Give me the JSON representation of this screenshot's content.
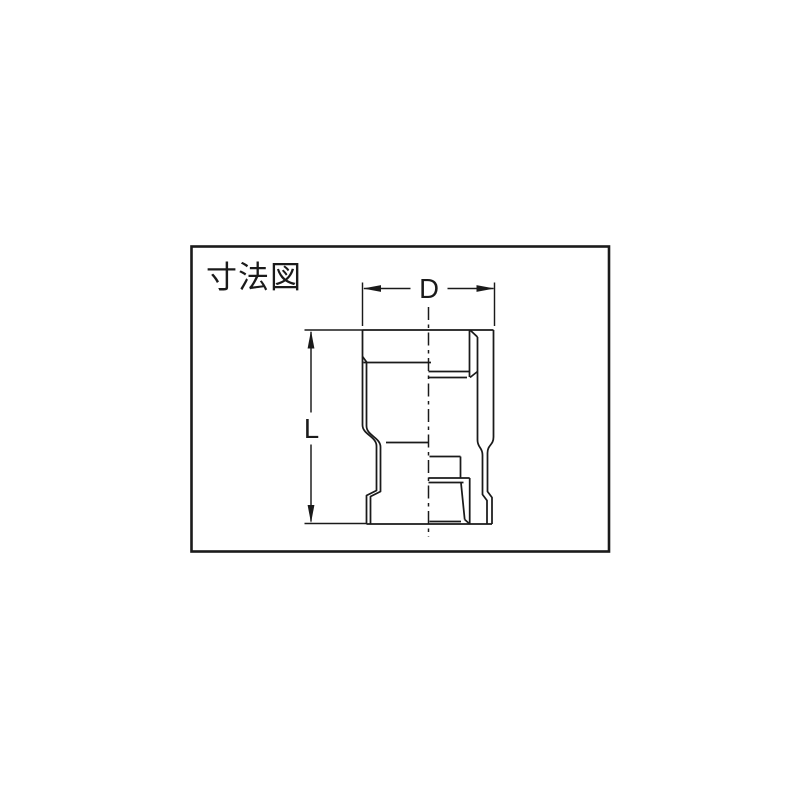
{
  "canvas": {
    "background": "#ffffff",
    "line_color": "#1a1a1a"
  },
  "panel": {
    "title": "寸法図"
  },
  "drawing": {
    "subject": "reducing-socket-pipe-fitting-half-section",
    "dimension_labels": {
      "diameter": "D",
      "length": "L"
    }
  }
}
